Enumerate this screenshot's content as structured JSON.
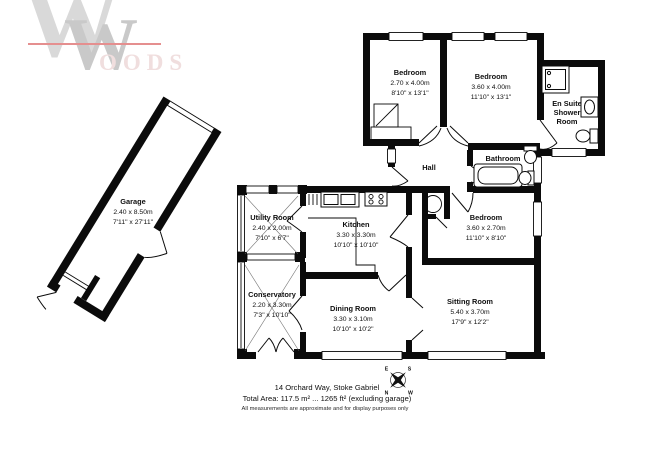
{
  "logo": {
    "monogram_large": "W",
    "monogram_small": "W",
    "word_suffix": "OODS",
    "accent_color": "#e58f8f",
    "gray_light": "#d9d9d9",
    "gray_mid": "#c9c9c9"
  },
  "rooms": [
    {
      "id": "garage",
      "name": "Garage",
      "metric": "2.40 x 8.50m",
      "imperial": "7'11\" x 27'11\""
    },
    {
      "id": "bedroom-1",
      "name": "Bedroom",
      "metric": "2.70 x 4.00m",
      "imperial": "8'10\" x 13'1\""
    },
    {
      "id": "bedroom-2",
      "name": "Bedroom",
      "metric": "3.60 x 4.00m",
      "imperial": "11'10\" x 13'1\""
    },
    {
      "id": "en-suite",
      "line1": "En Suite",
      "line2": "Shower",
      "line3": "Room"
    },
    {
      "id": "hall",
      "name": "Hall"
    },
    {
      "id": "bathroom",
      "name": "Bathroom"
    },
    {
      "id": "bedroom-3",
      "name": "Bedroom",
      "metric": "3.60 x 2.70m",
      "imperial": "11'10\" x 8'10\""
    },
    {
      "id": "utility",
      "name": "Utility Room",
      "metric": "2.40 x 2.00m",
      "imperial": "7'10\" x 6'7\""
    },
    {
      "id": "kitchen",
      "name": "Kitchen",
      "metric": "3.30 x 3.30m",
      "imperial": "10'10\" x 10'10\""
    },
    {
      "id": "conservatory",
      "name": "Conservatory",
      "metric": "2.20 x 3.30m",
      "imperial": "7'3\" x 10'10\""
    },
    {
      "id": "dining",
      "name": "Dining Room",
      "metric": "3.30 x 3.10m",
      "imperial": "10'10\" x 10'2\""
    },
    {
      "id": "sitting",
      "name": "Sitting Room",
      "metric": "5.40 x 3.70m",
      "imperial": "17'9\" x 12'2\""
    }
  ],
  "compass": {
    "north": "N",
    "south": "S",
    "east": "E",
    "west": "W"
  },
  "footer": {
    "address": "14 Orchard Way, Stoke Gabriel",
    "total_area": "Total Area: 117.5 m² ... 1265 ft² (excluding garage)",
    "disclaimer": "All measurements are approximate and for display purposes only"
  },
  "colors": {
    "wall": "#0b0b0b",
    "background": "#ffffff"
  }
}
